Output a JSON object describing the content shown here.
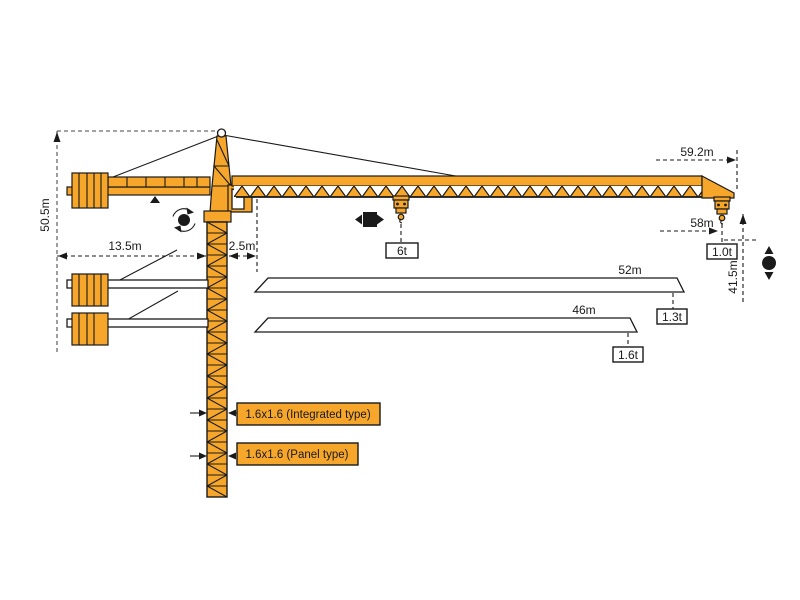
{
  "colors": {
    "crane": "#F5A62B",
    "ink": "#1a1a1a",
    "dim": "#6b6b6b"
  },
  "dimensions": {
    "overall_height": "50.5m",
    "counter_jib_radius": "13.5m",
    "jib_root_offset": "2.5m",
    "max_radius": "59.2m",
    "max_hook_radius": "58m",
    "lift_height": "41.5m"
  },
  "loads": {
    "trolley_mid": "6t",
    "jib_tip": "1.0t"
  },
  "jib_options": [
    {
      "length": "52m",
      "tip_capacity": "1.3t"
    },
    {
      "length": "46m",
      "tip_capacity": "1.6t"
    }
  ],
  "mast_types": [
    {
      "label": "1.6x1.6 (Integrated type)"
    },
    {
      "label": "1.6x1.6 (Panel type)"
    }
  ],
  "icons": {
    "slewing": "slewing-icon",
    "trolley_travel": "trolley-travel-icon",
    "hoisting": "hoisting-icon"
  }
}
